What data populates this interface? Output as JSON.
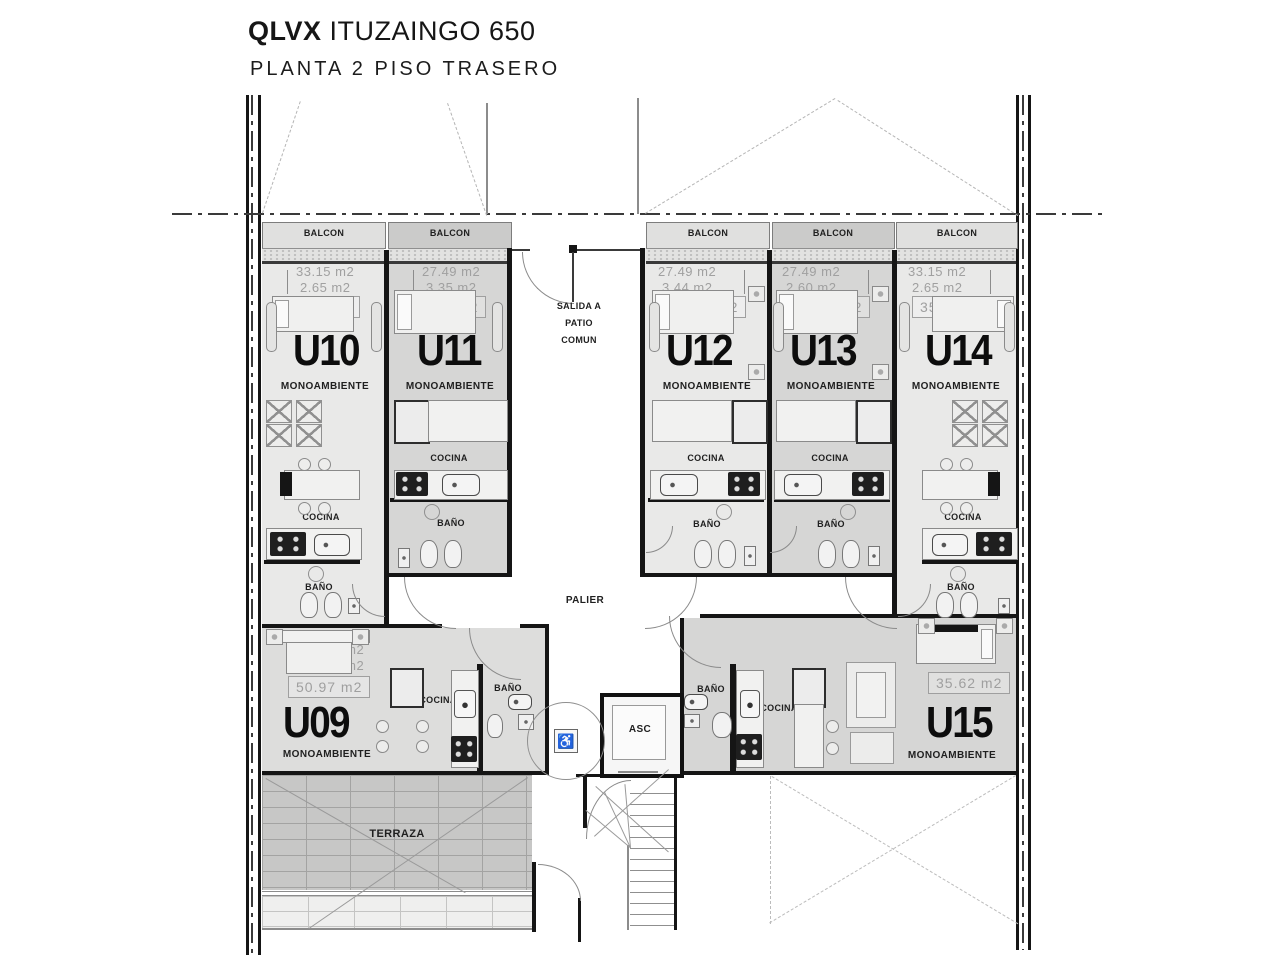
{
  "header": {
    "brand": "QLVX",
    "address": "ITUZAINGO 650",
    "plan_title": "PLANTA 2 PISO TRASERO"
  },
  "labels": {
    "balcony": "BALCON",
    "kitchen": "COCINA",
    "bathroom": "BAÑO",
    "hall": "PALIER",
    "terrace": "TERRAZA",
    "elevator": "ASC",
    "exit_line1": "SALIDA A",
    "exit_line2": "PATIO",
    "exit_line3": "COMUN"
  },
  "units": {
    "u09": {
      "id": "U09",
      "type": "MONOAMBIENTE",
      "covered": "28.48 m2",
      "uncovered": "22.49 m2",
      "total": "50.97 m2"
    },
    "u10": {
      "id": "U10",
      "type": "MONOAMBIENTE",
      "covered": "33.15 m2",
      "uncovered": "2.65 m2",
      "total": "35.80 m2"
    },
    "u11": {
      "id": "U11",
      "type": "MONOAMBIENTE",
      "covered": "27.49 m2",
      "uncovered": "3.35 m2",
      "total": "30.84 m2"
    },
    "u12": {
      "id": "U12",
      "type": "MONOAMBIENTE",
      "covered": "27.49 m2",
      "uncovered": "3.44 m2",
      "total": "30.93 m2"
    },
    "u13": {
      "id": "U13",
      "type": "MONOAMBIENTE",
      "covered": "27.49 m2",
      "uncovered": "2.60 m2",
      "total": "30.09 m2"
    },
    "u14": {
      "id": "U14",
      "type": "MONOAMBIENTE",
      "covered": "33.15 m2",
      "uncovered": "2.65 m2",
      "total": "35.80 m2"
    },
    "u15": {
      "id": "U15",
      "type": "MONOAMBIENTE",
      "total": "35.62 m2"
    }
  },
  "colors": {
    "wall": "#151515",
    "thin_line": "#8c8c8c",
    "dimension_text": "#9f9f9f",
    "label_text": "#1f1f1f",
    "unit_light": "#e9e9e8",
    "unit_dark": "#d6d6d5",
    "terrace_fill": "#c7c7c6",
    "background": "#ffffff"
  }
}
